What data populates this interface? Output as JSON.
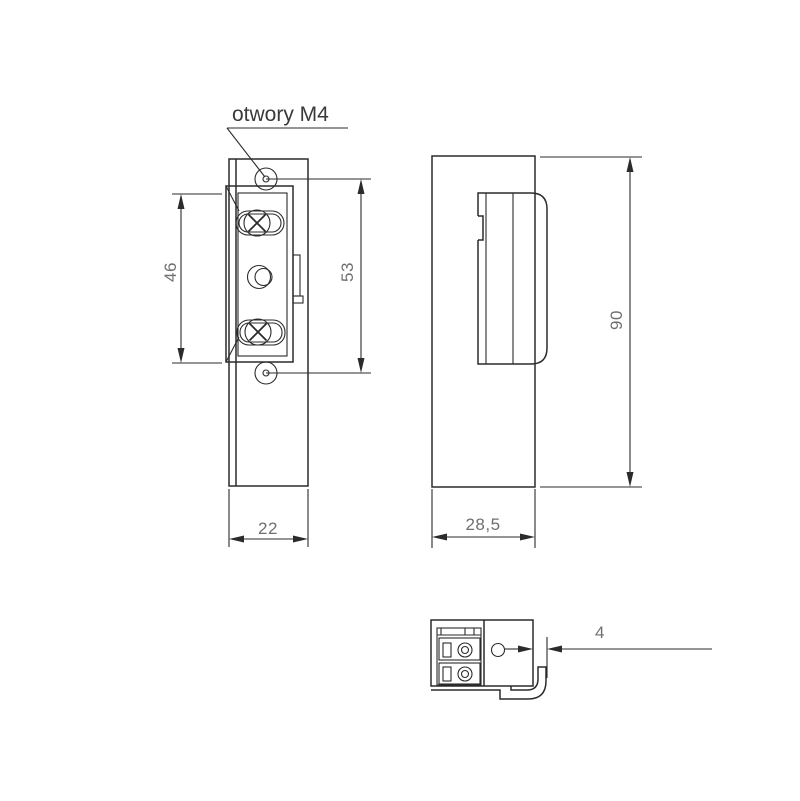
{
  "drawing": {
    "label_otwory": "otwory M4",
    "front_view": {
      "dim_keeper_height": "46",
      "dim_hole_spacing": "53",
      "dim_width": "22"
    },
    "side_view": {
      "dim_height": "90",
      "dim_depth": "28,5"
    },
    "top_view": {
      "dim_lip_offset": "4"
    }
  },
  "colors": {
    "line": "#2b2b2b",
    "dim_text": "#6f6f6f",
    "label_text": "#3a3a3a",
    "background": "#ffffff"
  }
}
